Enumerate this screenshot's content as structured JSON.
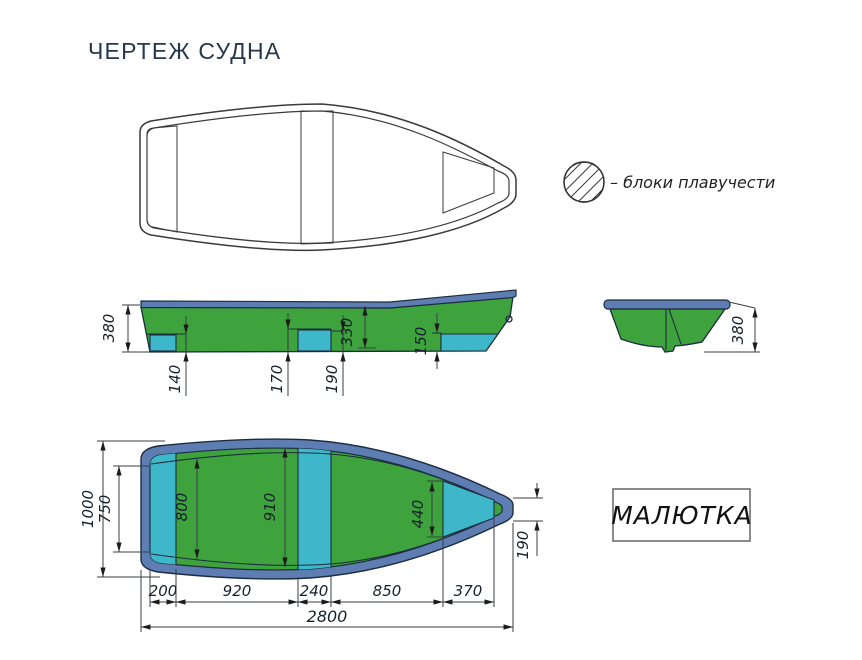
{
  "title": "ЧЕРТЕЖ СУДНА",
  "legend": {
    "symbol": "hatched-circle",
    "label": "–  блоки плавучести"
  },
  "model_box": {
    "label": "МАЛЮТКА"
  },
  "views": {
    "side": {
      "dims": {
        "height": "380",
        "stern_shelf": "140",
        "mid_shelf": "170",
        "mid_step": "190",
        "inner_depth": "330",
        "bow_shelf": "150"
      }
    },
    "transom": {
      "dims": {
        "height": "380"
      }
    },
    "plan": {
      "dims": {
        "beam_overall": "1000",
        "beam_stern_inner": "750",
        "floor_width_stern": "800",
        "floor_width_mid": "910",
        "bow_block_width": "440",
        "bow_tip_width": "190",
        "chain": [
          "200",
          "920",
          "240",
          "850",
          "370"
        ],
        "length_overall": "2800"
      }
    }
  },
  "colors": {
    "hull_green": "#3EA33C",
    "block_cyan": "#3FB7CB",
    "gunwale_blue": "#5E7DB3",
    "outline_dark": "#1D2D3E",
    "title_text": "#26374E"
  }
}
